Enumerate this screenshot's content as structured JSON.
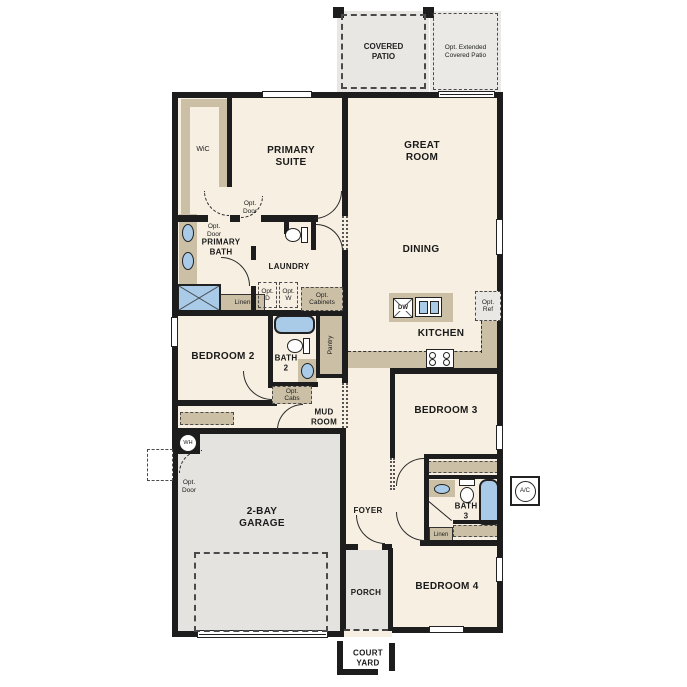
{
  "plan_title": "Single-story floor plan",
  "colors": {
    "wall": "#1d1d1d",
    "interior": "#f7efe2",
    "concrete": "#e4e3df",
    "counter": "#cbbfa5",
    "fixture_blue": "#a9cbe8"
  },
  "labels": {
    "covered_patio": "COVERED\nPATIO",
    "opt_extended_patio": "Opt. Extended\nCovered Patio",
    "wic": "WiC",
    "primary_suite": "PRIMARY\nSUITE",
    "primary_bath": "PRIMARY\nBATH",
    "opt_door": "Opt.\nDoor",
    "laundry": "LAUNDRY",
    "opt_d": "Opt.\nD",
    "opt_w": "Opt.\nW",
    "opt_cabinets": "Opt.\nCabinets",
    "linen": "Linen",
    "great_room": "GREAT\nROOM",
    "dining": "DINING",
    "kitchen": "KITCHEN",
    "dw": "DW",
    "opt_ref": "Opt.\nRef",
    "bedroom2": "BEDROOM 2",
    "bath2": "BATH\n2",
    "pantry": "Pantry",
    "opt_cabs": "Opt.\nCabs",
    "mud_room": "MUD\nROOM",
    "bedroom3": "BEDROOM 3",
    "bath3": "BATH\n3",
    "bedroom4": "BEDROOM 4",
    "garage": "2-BAY\nGARAGE",
    "wh": "WH",
    "foyer": "FOYER",
    "porch": "PORCH",
    "court_yard": "COURT\nYARD",
    "ac": "A/C"
  }
}
